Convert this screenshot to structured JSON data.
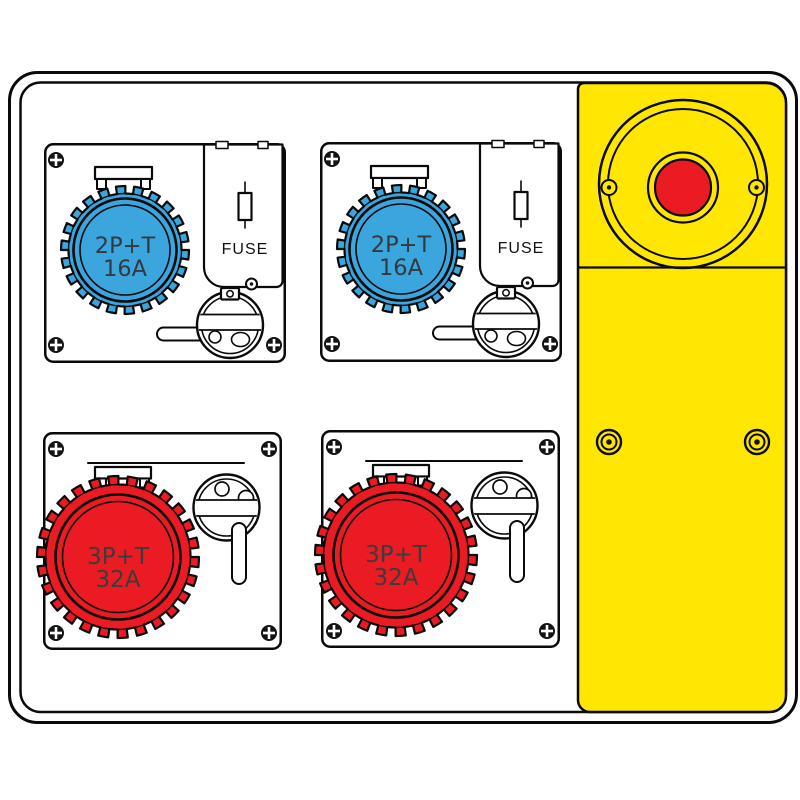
{
  "panel": {
    "modules": [
      {
        "id": "top-left",
        "rating_line1": "2P+T",
        "rating_line2": "16A",
        "fuse_label": "FUSE",
        "socket_color": "#3BA6DE"
      },
      {
        "id": "top-right",
        "rating_line1": "2P+T",
        "rating_line2": "16A",
        "fuse_label": "FUSE",
        "socket_color": "#3BA6DE"
      },
      {
        "id": "bottom-left",
        "rating_line1": "3P+T",
        "rating_line2": "32A",
        "socket_color": "#EA1B23"
      },
      {
        "id": "bottom-right",
        "rating_line1": "3P+T",
        "rating_line2": "32A",
        "socket_color": "#EA1B23"
      }
    ],
    "emergency_section": {
      "panel_color": "#FFE603",
      "button_color": "#EA1B23"
    },
    "icons": {
      "corner_fastener": "phillips-screw",
      "fuse_symbol": "iec-fuse",
      "emergency_button": "emergency-stop-button",
      "interlock": "rotary-interlock-disc"
    },
    "line_color": "#0a0a0a"
  }
}
